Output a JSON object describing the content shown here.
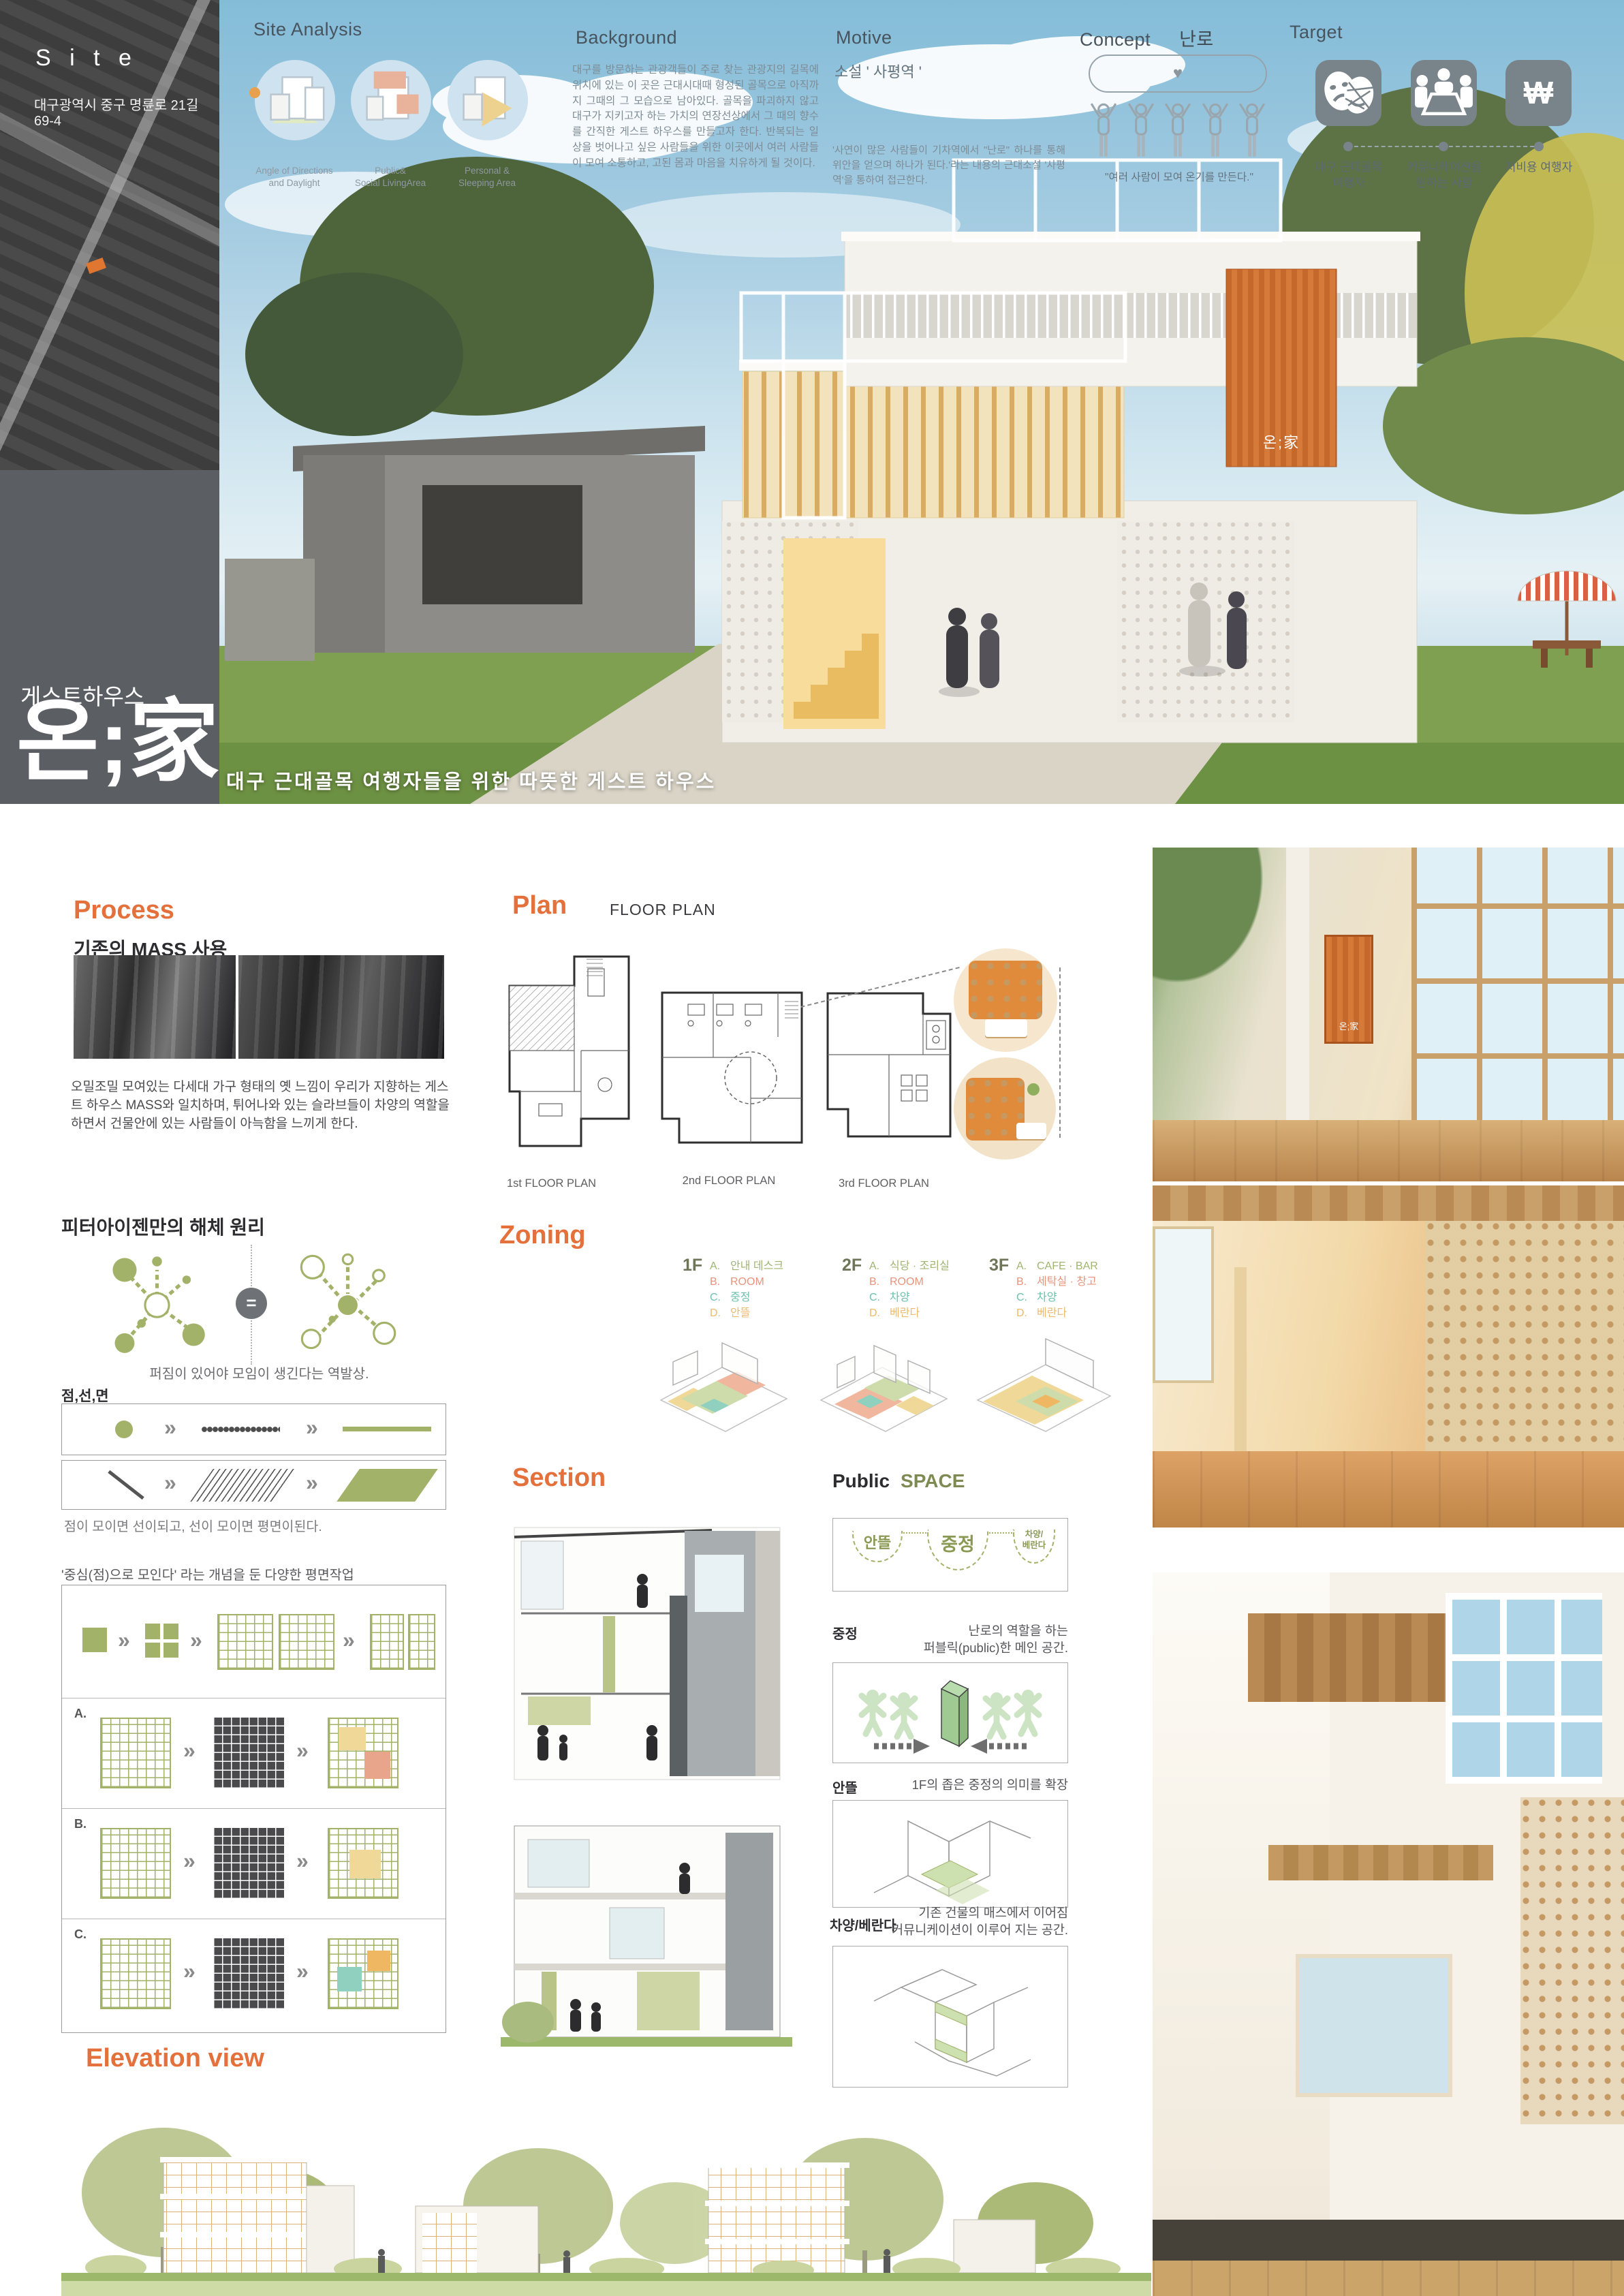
{
  "colors": {
    "accent_orange": "#e4703c",
    "accent_green": "#a3b269",
    "panel_gray": "#5b5f64",
    "sky_blue": "#a7cde2",
    "zone_a_green": "#a0b472",
    "zone_b_salmon": "#e8947c",
    "zone_c_teal": "#6ec0ae",
    "zone_d_orange": "#eeb96e"
  },
  "site": {
    "label": "S i t e",
    "address": "대구광역시 중구 명륜로 21길 69-4"
  },
  "header": {
    "site_analysis": {
      "title": "Site Analysis",
      "items": [
        {
          "icon": "daylight-diagram",
          "label": "Angle of Directions\nand Daylight"
        },
        {
          "icon": "public-area-diagram",
          "label": "Public&\nSocial LivingArea"
        },
        {
          "icon": "personal-area-diagram",
          "label": "Personal &\nSleeping Area"
        }
      ]
    },
    "background": {
      "title": "Background",
      "body": "대구를 방문하는 관광객들이 주로 찾는 관광지의 길목에 위치에 있는 이 곳은 근대시대때 형성된 골목으로 아직까지 그때의 그 모습으로 남아있다. 골목을 파괴하지 않고 대구가 지키고자 하는 가치의 연장선상에서 그 때의 향수를 간직한 게스트 하우스를 만들고자 한다. 반복되는 일상을 벗어나고 싶은 사람들을 위한 이곳에서 여러 사람들이 모여 소통하고, 고된 몸과 마음을 치유하게 될 것이다."
    },
    "motive": {
      "title": "Motive",
      "subtitle": "소설 ' 사평역 '",
      "body": "'사연이 많은 사람들이 기차역에서 \"난로\" 하나를 통해 위안을 얻으며 하나가 된다.'라는 내용의 근대소설 '사평역'을 통하여 접근한다."
    },
    "concept": {
      "title": "Concept",
      "keyword": "난로",
      "heart": "♥",
      "caption": "\"여러 사람이 모여 온기를 만든다.\""
    },
    "target": {
      "title": "Target",
      "won_symbol": "₩",
      "items": [
        {
          "icon": "theater-masks-icon",
          "label": "대구 근대골목\n여행자"
        },
        {
          "icon": "meeting-table-icon",
          "label": "커뮤니케이션을\n원하는 사람"
        },
        {
          "icon": "won-currency-icon",
          "label": "저비용 여행자"
        }
      ]
    }
  },
  "title_block": {
    "category": "게스트하우스",
    "name_prefix": "온;",
    "name_hanja": "家",
    "sign_text": "온;家",
    "subtitle": "대구 근대골목 여행자들을 위한 따뜻한 게스트 하우스"
  },
  "process": {
    "title": "Process",
    "chevron_glyph": "»",
    "mass": {
      "heading": "기존의 MASS 사용",
      "body": "오밀조밀 모여있는 다세대 가구 형태의 옛 느낌이 우리가 지향하는 게스트 하우스 MASS와 일치하며, 튀어나와 있는 슬라브들이 차양의 역할을 하면서 건물안에 있는 사람들이 아늑함을 느끼게 한다."
    },
    "eisenman": {
      "heading": "피터아이젠만의 해체 원리",
      "equals": "=",
      "caption": "퍼짐이 있어야 모임이 생긴다는 역발상."
    },
    "point_line_plane": {
      "heading": "점,선,면",
      "caption": "점이 모이면 선이되고, 선이 모이면 평면이된다."
    },
    "plan_studies": {
      "caption": "'중심(점)으로 모인다' 라는 개념을 둔 다양한 평면작업",
      "rows": [
        {
          "label": "A."
        },
        {
          "label": "B."
        },
        {
          "label": "C."
        }
      ]
    }
  },
  "plan": {
    "title": "Plan",
    "subtitle": "FLOOR PLAN",
    "labels": [
      "1st FLOOR PLAN",
      "2nd FLOOR PLAN",
      "3rd FLOOR PLAN"
    ]
  },
  "zoning": {
    "title": "Zoning",
    "floors": [
      {
        "floor": "1F",
        "items": [
          {
            "key": "A.",
            "label": "안내 데스크"
          },
          {
            "key": "B.",
            "label": "ROOM"
          },
          {
            "key": "C.",
            "label": "중정"
          },
          {
            "key": "D.",
            "label": "안뜰"
          }
        ]
      },
      {
        "floor": "2F",
        "items": [
          {
            "key": "A.",
            "label": "식당 · 조리실"
          },
          {
            "key": "B.",
            "label": "ROOM"
          },
          {
            "key": "C.",
            "label": "차양"
          },
          {
            "key": "D.",
            "label": "베란다"
          }
        ]
      },
      {
        "floor": "3F",
        "items": [
          {
            "key": "A.",
            "label": "CAFE · BAR"
          },
          {
            "key": "B.",
            "label": "세탁실 · 창고"
          },
          {
            "key": "C.",
            "label": "차양"
          },
          {
            "key": "D.",
            "label": "베란다"
          }
        ]
      }
    ]
  },
  "section": {
    "title": "Section"
  },
  "public_space": {
    "title_black": "Public",
    "title_green": "SPACE",
    "diagram_labels": [
      "안뜰",
      "중정",
      "차양/\n베란다"
    ],
    "entries": [
      {
        "label": "중정",
        "desc": "난로의 역할을 하는\n퍼블릭(public)한 메인 공간."
      },
      {
        "label": "안뜰",
        "desc": "1F의 좁은 중정의 의미를 확장"
      },
      {
        "label": "차양/베란다",
        "desc": "기존 건물의 매스에서 이어짐\n커뮤니케이션이 이루어 지는 공간."
      }
    ]
  },
  "elevation": {
    "title": "Elevation view"
  }
}
